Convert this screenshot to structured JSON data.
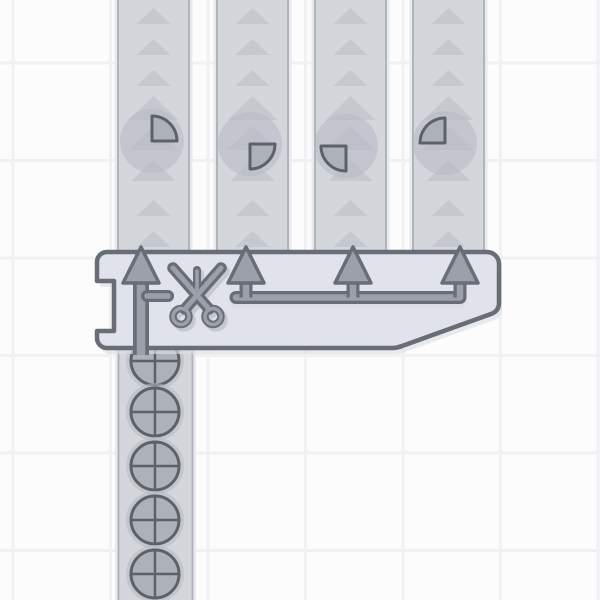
{
  "app": {
    "title": "factory-puzzle-game",
    "view": "quad-cutter-scene"
  },
  "colors": {
    "background": "#fcfcfd",
    "grid_line": "#f1f1f4",
    "belt_fill": "#d3d6db",
    "belt_edge": "#b0b4bc",
    "belt_halo": "#e9eaee",
    "belt_arrow": "#c5c8ce",
    "item_ghost": "#b6bac3",
    "item_fill": "#adb1b8",
    "item_stroke": "#5d6269",
    "machine_fill": "#e0e3eb",
    "machine_stroke": "#686d76",
    "metal_fill": "#9ba0aa",
    "metal_stroke": "#686d76",
    "icon_shadow": "#c6c9d0",
    "machine_shadow": "#dcdfe4"
  },
  "grid": {
    "pitch": 97.5,
    "offset_x": 13,
    "offset_y": 63,
    "line_width": 3
  },
  "belts": {
    "direction": "up",
    "width": 73,
    "top": 0,
    "bottom": 252,
    "chevrons": [
      {
        "y": 8,
        "w": 34,
        "h": 16
      },
      {
        "y": 39,
        "w": 34,
        "h": 16
      },
      {
        "y": 70,
        "w": 34,
        "h": 16
      },
      {
        "y": 96,
        "w": 50,
        "h": 24
      },
      {
        "y": 126,
        "w": 50,
        "h": 24
      },
      {
        "y": 160,
        "w": 44,
        "h": 21
      },
      {
        "y": 200,
        "w": 34,
        "h": 16
      },
      {
        "y": 231,
        "w": 34,
        "h": 16
      }
    ],
    "lanes": [
      {
        "center_x": 153.5,
        "item": {
          "shape": "quarter",
          "quadrant": "top-right",
          "x": 152,
          "y": 141,
          "radius": 25
        }
      },
      {
        "center_x": 252.5,
        "item": {
          "shape": "quarter",
          "quadrant": "bottom-right",
          "x": 250,
          "y": 144,
          "radius": 25
        }
      },
      {
        "center_x": 350.5,
        "item": {
          "shape": "quarter",
          "quadrant": "bottom-left",
          "x": 346,
          "y": 146,
          "radius": 25
        }
      },
      {
        "center_x": 448.5,
        "item": {
          "shape": "quarter",
          "quadrant": "top-left",
          "x": 445,
          "y": 143,
          "radius": 25
        }
      }
    ],
    "ghost_radius": 32
  },
  "machine": {
    "name": "quad-cutter",
    "icon": "scissors-icon",
    "body_path": "M107,252 L487,252 A12,12 0 0 1 499,264 L499,303 Q499,311 491,314 L402,346 Q397,348 392,348 L107,348 A10,10 0 0 1 97,338 L97,331 L114,331 L114,281 L97,281 L97,262 A10,10 0 0 1 107,252 Z",
    "outputs": [
      {
        "x": 141,
        "full_shaft": true,
        "stub": true
      },
      {
        "x": 246
      },
      {
        "x": 353
      },
      {
        "x": 460
      }
    ],
    "arrow_base_y": 283,
    "arrow_tip_y": 247,
    "arrow_half_width": 18,
    "pipe": {
      "x1": 236,
      "x2": 460,
      "y": 297.5
    },
    "stub": {
      "x1": 147,
      "x2": 168,
      "y": 296
    },
    "shaft_bottom_y": 355,
    "scissors": {
      "cx": 197,
      "cy": 297
    }
  },
  "input_lane": {
    "direction": "up",
    "center_x": 155,
    "left": 117.5,
    "width": 76,
    "top": 348,
    "bottom": 600,
    "ghost_radius": 29,
    "items": [
      {
        "shape": "circle-cross",
        "y": 361,
        "radius": 24
      },
      {
        "shape": "circle-cross",
        "y": 412,
        "radius": 24
      },
      {
        "shape": "circle-cross",
        "y": 466,
        "radius": 24
      },
      {
        "shape": "circle-cross",
        "y": 520,
        "radius": 24
      },
      {
        "shape": "circle-cross",
        "y": 574,
        "radius": 24
      }
    ]
  }
}
